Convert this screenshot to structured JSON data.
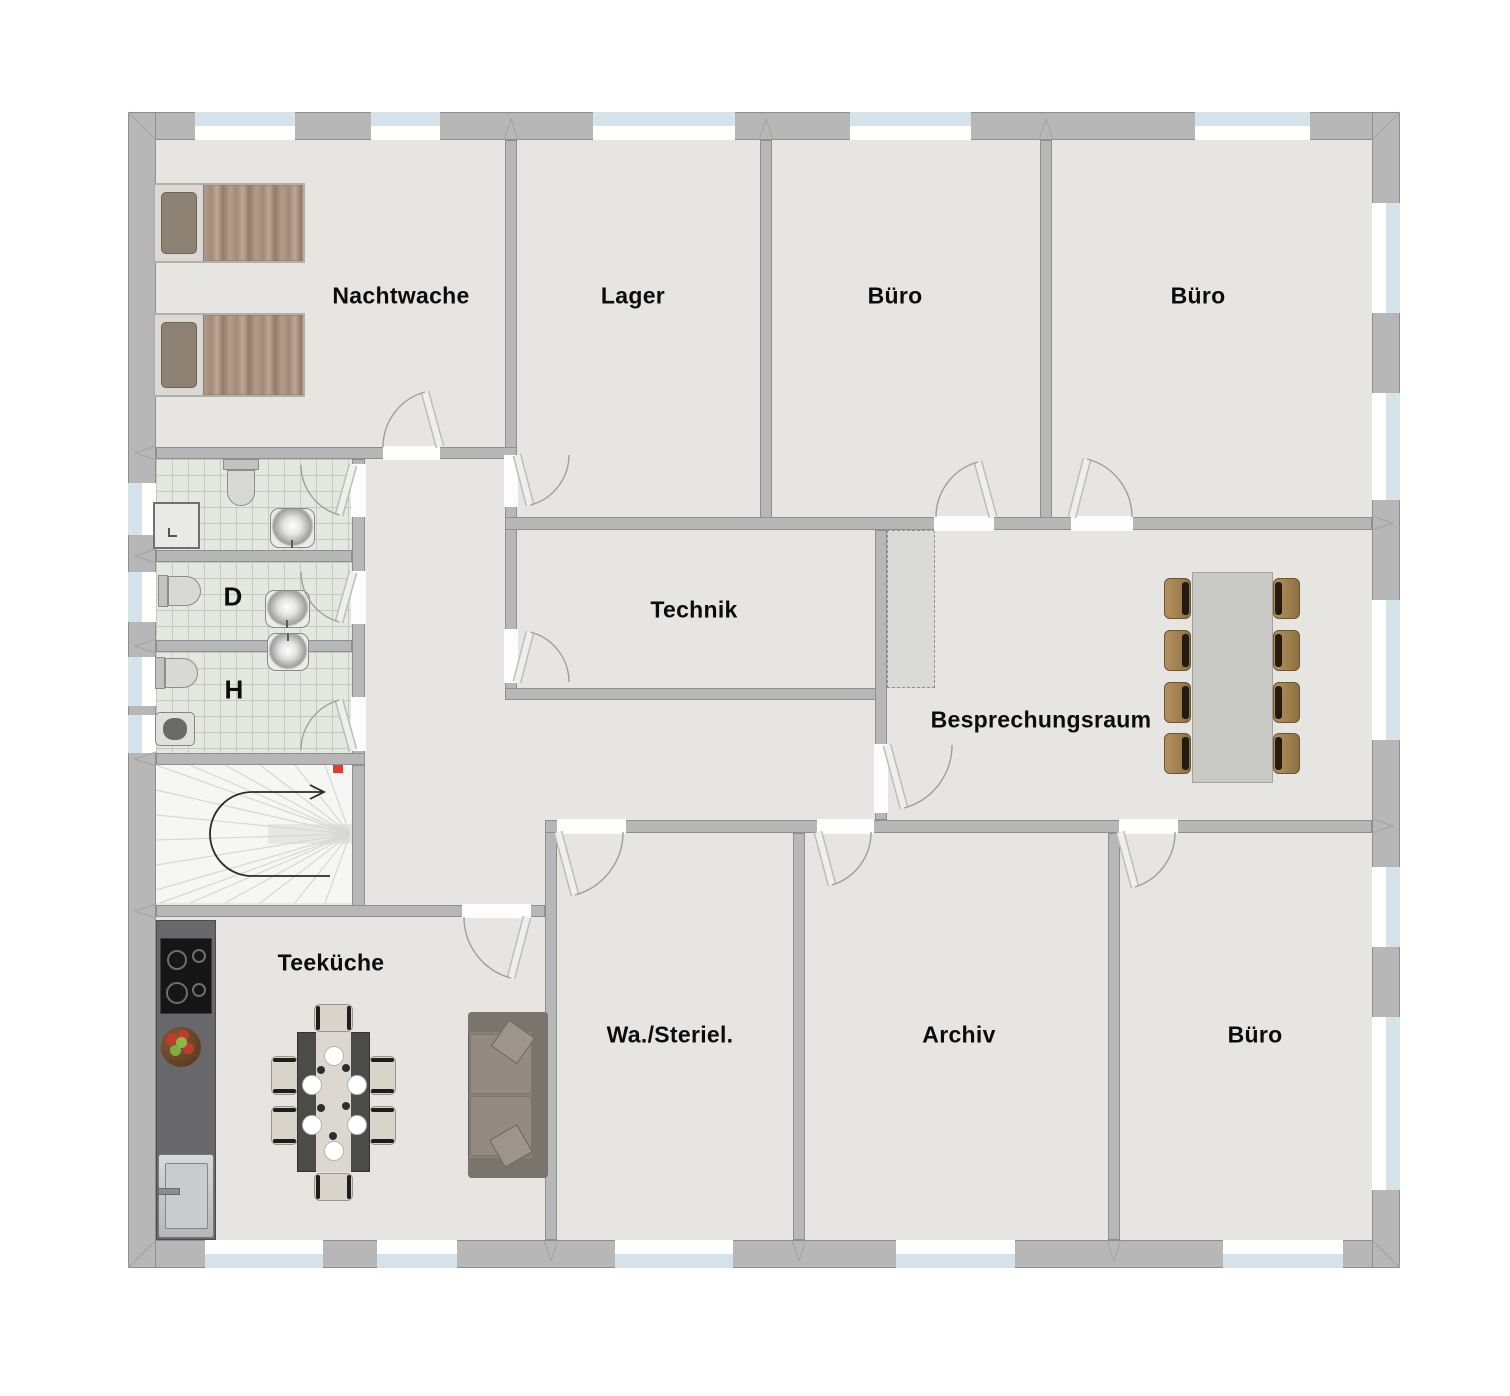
{
  "floorplan": {
    "rooms": [
      {
        "id": "nachtwache",
        "label": "Nachtwache"
      },
      {
        "id": "lager",
        "label": "Lager"
      },
      {
        "id": "buero-top-mid",
        "label": "Büro"
      },
      {
        "id": "buero-top-right",
        "label": "Büro"
      },
      {
        "id": "technik",
        "label": "Technik"
      },
      {
        "id": "besprechungsraum",
        "label": "Besprechungsraum"
      },
      {
        "id": "wc-damen",
        "label": "D"
      },
      {
        "id": "wc-herren",
        "label": "H"
      },
      {
        "id": "teekueche",
        "label": "Teeküche"
      },
      {
        "id": "wasch-sterilisation",
        "label": "Wa./Steriel."
      },
      {
        "id": "archiv",
        "label": "Archiv"
      },
      {
        "id": "buero-bottom-right",
        "label": "Büro"
      }
    ],
    "fixtures": [
      {
        "name": "bed",
        "count": 2
      },
      {
        "name": "toilet",
        "count": 3
      },
      {
        "name": "urinal",
        "count": 1
      },
      {
        "name": "washbasin",
        "count": 3
      },
      {
        "name": "shower",
        "count": 1
      },
      {
        "name": "staircase-with-up-arrow",
        "count": 1
      },
      {
        "name": "kitchen-counter-with-stove-and-sink",
        "count": 1
      },
      {
        "name": "fruit-bowl",
        "count": 1
      },
      {
        "name": "dining-table-6-chairs",
        "count": 1
      },
      {
        "name": "sofa",
        "count": 1
      },
      {
        "name": "conference-table-8-chairs",
        "count": 1
      }
    ],
    "colors": {
      "wall": "#b7b7b7",
      "floor": "#e6e5e2",
      "tile": "#e4e8e0",
      "window_glass": "#d4e3ea",
      "door_leaf": "#ececea",
      "stair": "#f6f6f4",
      "bed_blanket": "#ab9486",
      "sofa": "#8a8279",
      "dining_table": "#4b4b49",
      "conference_table": "#c9c9c6",
      "conference_chair": "#9b7c53",
      "accent_red": "#e23b2f"
    }
  }
}
